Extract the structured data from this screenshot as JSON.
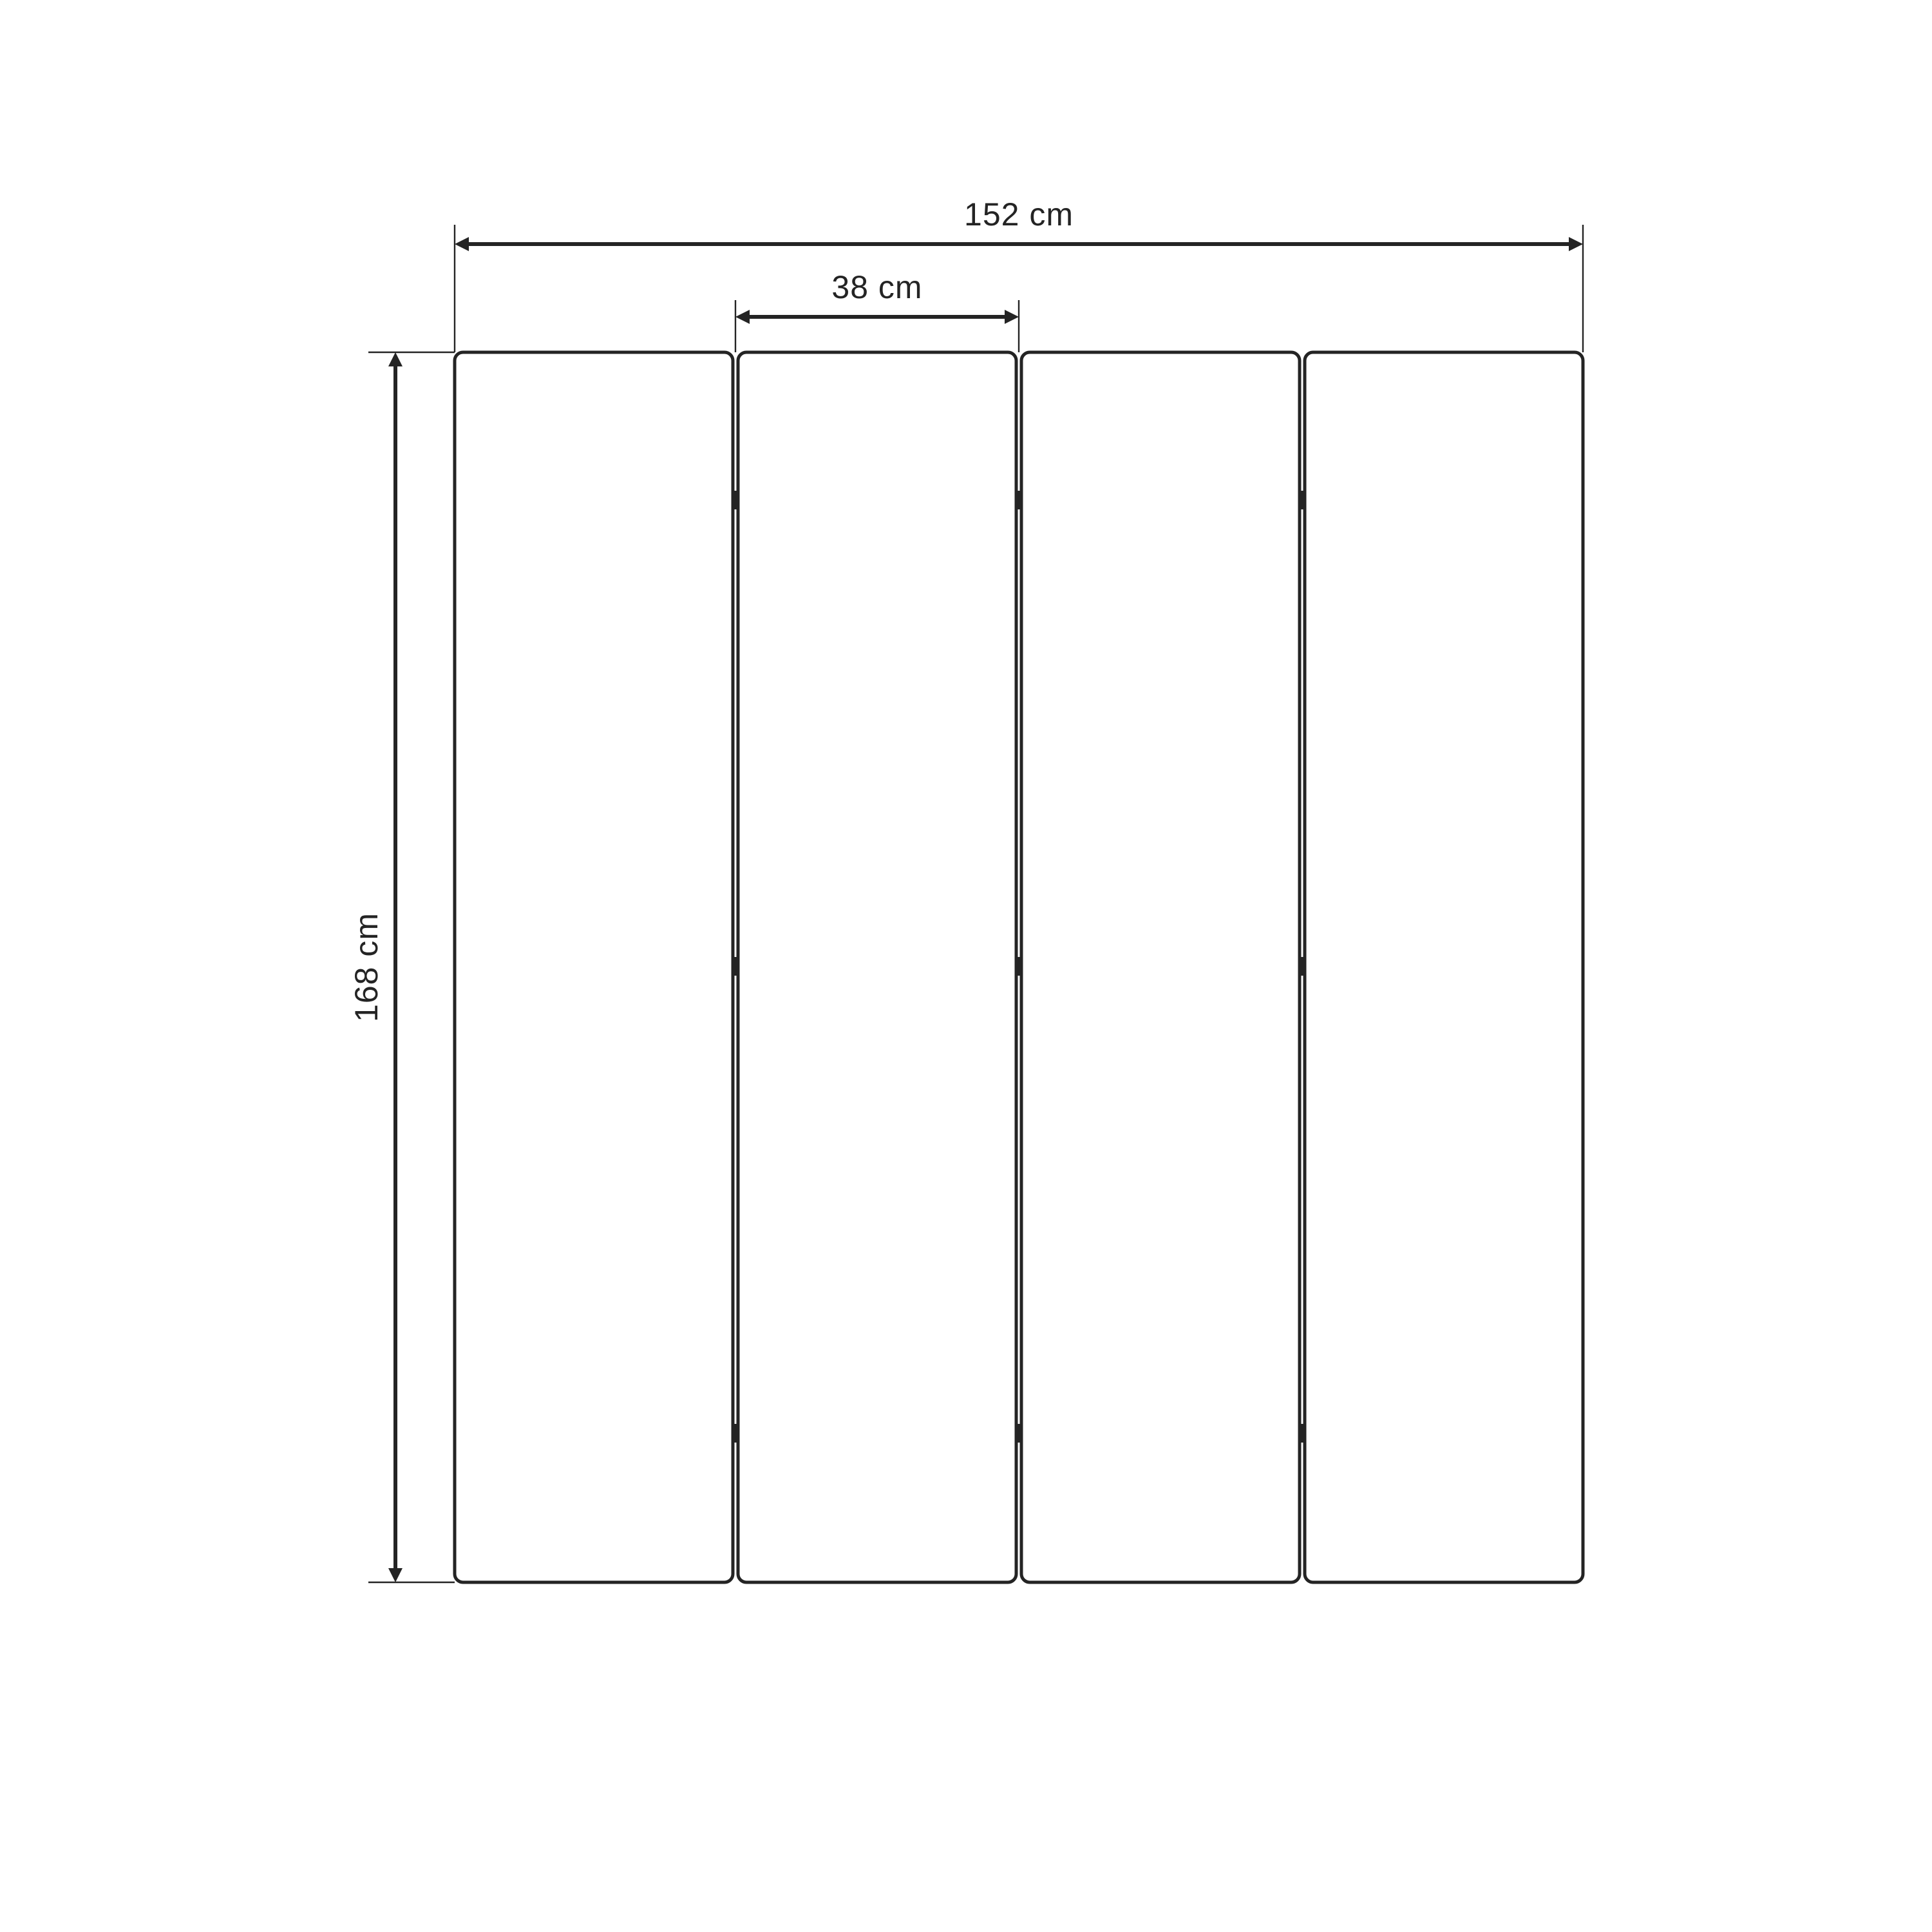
{
  "dimension_labels": {
    "total_width": "152 cm",
    "panel_width": "38 cm",
    "height": "168 cm"
  },
  "structure": {
    "panel_count": 4,
    "hinge_columns": 3,
    "hinges_per_column": 3
  },
  "colors": {
    "line": "#242424",
    "panel_fill": "#ffffff",
    "background": "#ffffff"
  }
}
